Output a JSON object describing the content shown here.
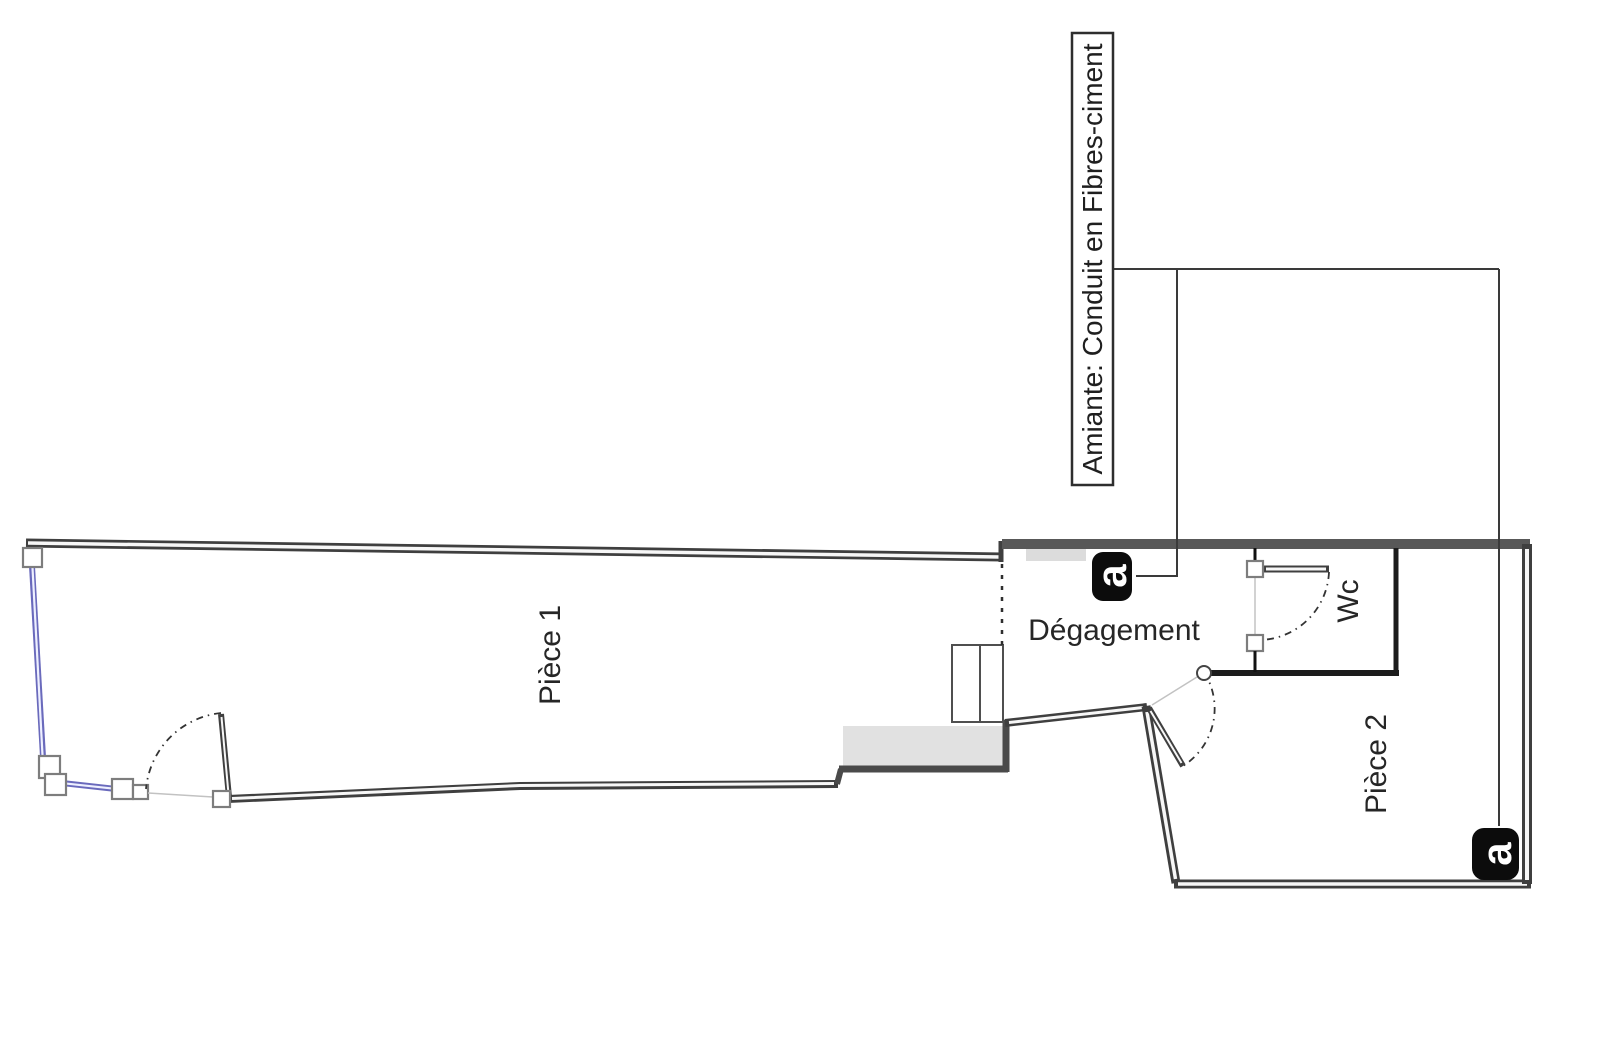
{
  "plan": {
    "type": "floor-plan",
    "rooms": {
      "piece1": "Pièce 1",
      "degagement": "Dégagement",
      "wc": "Wc",
      "piece2": "Pièce 2"
    },
    "annotation": {
      "label": "Amiante: Conduit en Fibres-ciment",
      "marker_letter": "a",
      "marker_count": 2
    },
    "colors": {
      "wall_dark": "#3f3f3f",
      "wall_gray": "#585858",
      "wall_black": "#1c1c1c",
      "fill_light": "#e1e1e1",
      "blue_wall": "#6a6abc",
      "marker_bg": "#0c0c0c",
      "marker_fg": "#ffffff",
      "text": "#262626"
    }
  }
}
